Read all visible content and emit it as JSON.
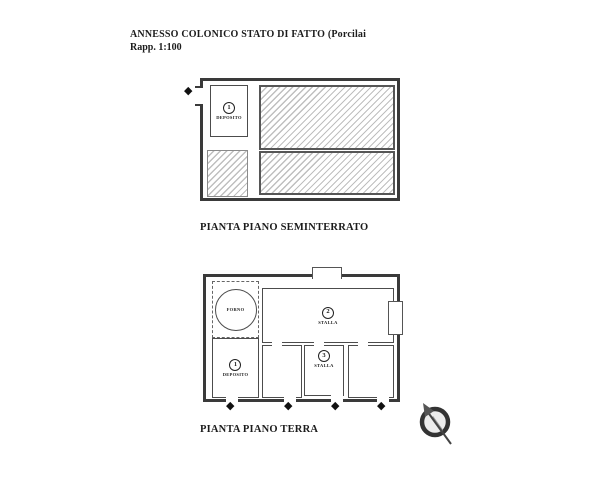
{
  "header": {
    "title": "ANNESSO COLONICO STATO DI FATTO (Porcilai",
    "scale": "Rapp. 1:100"
  },
  "icons": {
    "entrance_diamond": "◆"
  },
  "plans": {
    "seminterrato": {
      "caption": "PIANTA PIANO SEMINTERRATO",
      "rooms": {
        "deposito": {
          "number": "1",
          "name": "DEPOSITO"
        }
      }
    },
    "terra": {
      "caption": "PIANTA PIANO TERRA",
      "rooms": {
        "forno": {
          "name": "FORNO"
        },
        "deposito": {
          "number": "1",
          "name": "DEPOSITO"
        },
        "stalla_grande": {
          "number": "2",
          "name": "STALLA"
        },
        "stalla_piccola": {
          "number": "3",
          "name": "STALLA"
        }
      }
    }
  },
  "colors": {
    "wall": "#3a3a3a",
    "hatch_line": "#bfbfbf",
    "background": "#ffffff"
  }
}
